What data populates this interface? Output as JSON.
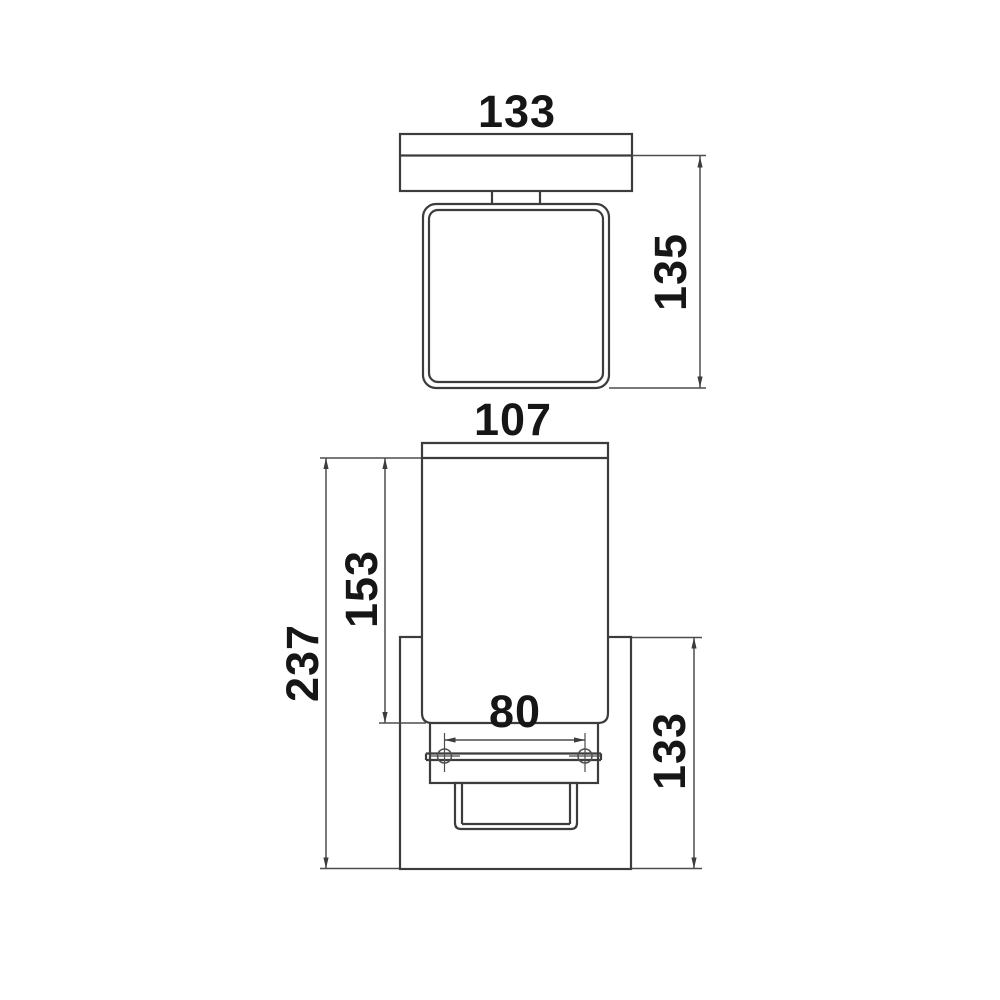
{
  "drawing": {
    "kind": "technical-dimension-drawing",
    "colors": {
      "background": "#ffffff",
      "object_line": "#3c3c3c",
      "dimension_line": "#4d4d4d",
      "text": "#161616"
    },
    "views": {
      "top": {
        "dims": {
          "plate_width": "133",
          "projection": "135"
        }
      },
      "front": {
        "dims": {
          "shade_width": "107",
          "shade_height": "153",
          "overall_height": "237",
          "screw_spacing": "80",
          "backplate_height": "133"
        }
      }
    }
  }
}
